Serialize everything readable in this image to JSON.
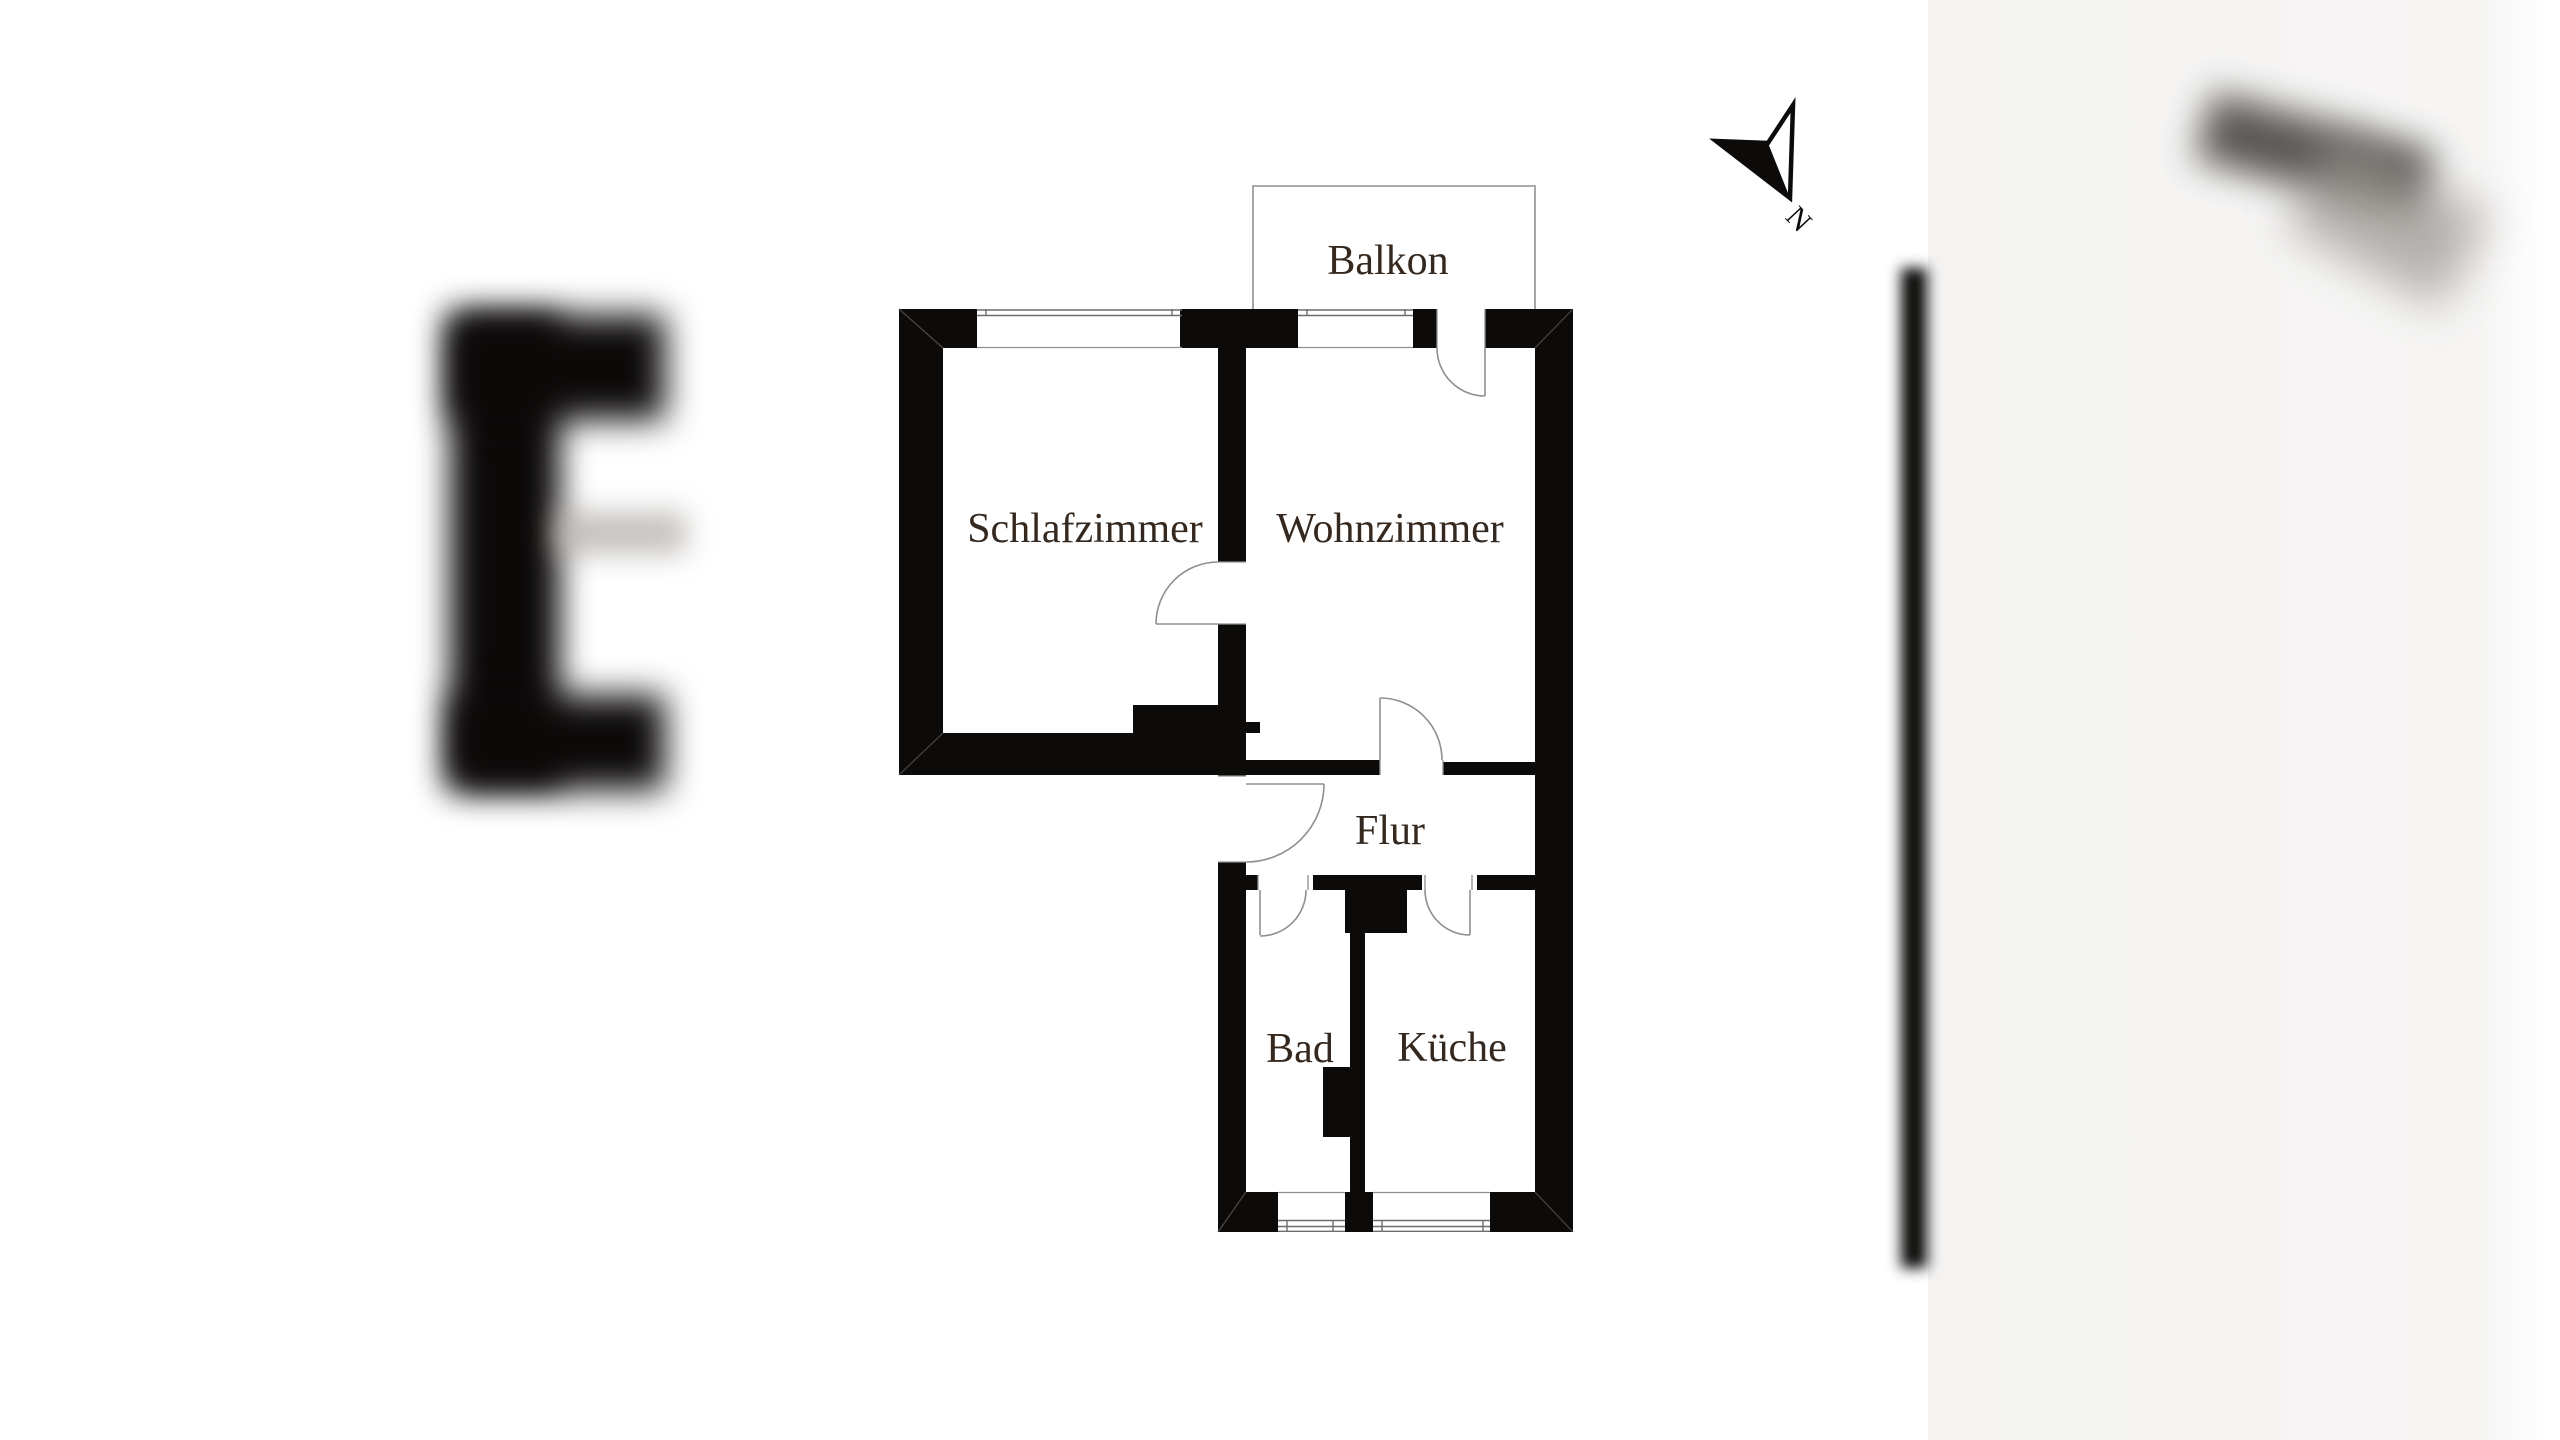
{
  "floorplan": {
    "rooms": [
      {
        "id": "schlafzimmer",
        "label": "Schlafzimmer"
      },
      {
        "id": "wohnzimmer",
        "label": "Wohnzimmer"
      },
      {
        "id": "balkon",
        "label": "Balkon"
      },
      {
        "id": "flur",
        "label": "Flur"
      },
      {
        "id": "bad",
        "label": "Bad"
      },
      {
        "id": "kueche",
        "label": "Küche"
      }
    ],
    "compass": {
      "label": "N"
    },
    "colors": {
      "wall": "#0d0b0a",
      "label_text": "#35281f",
      "thin_line": "#8f8f8f"
    }
  }
}
